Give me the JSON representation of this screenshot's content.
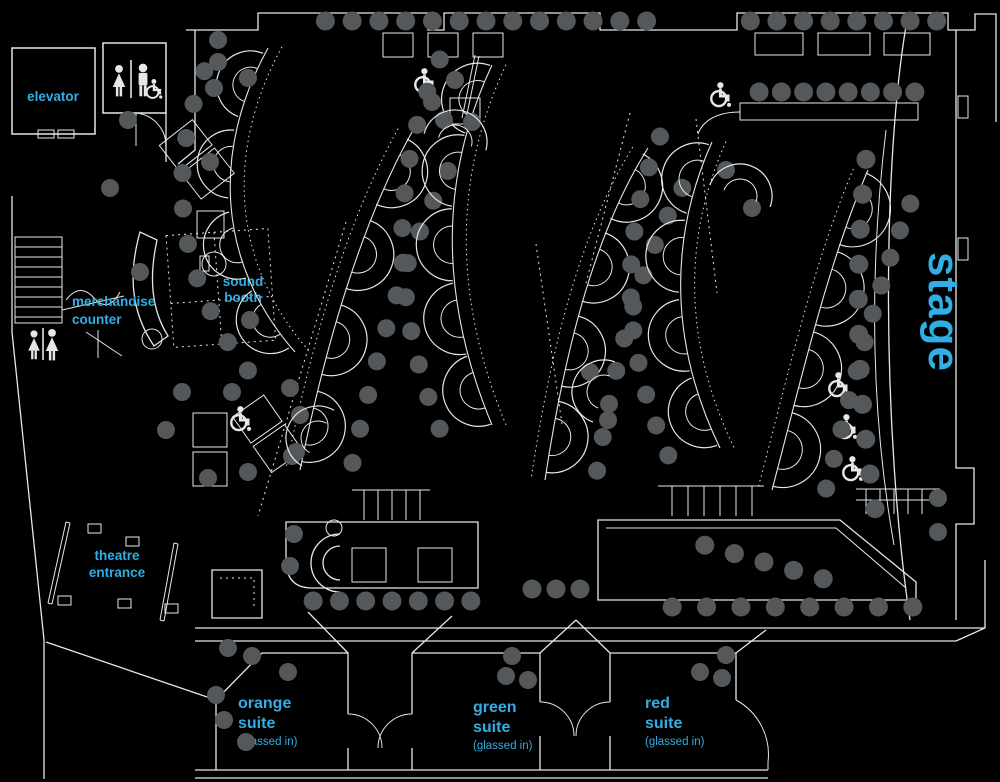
{
  "colors": {
    "background": "#000000",
    "line": "#e6e7e8",
    "seat": "#54585a",
    "accent": "#31aee4"
  },
  "areas": {
    "elevator": {
      "label": "elevator"
    },
    "merchandise_counter": {
      "line1": "merchandise",
      "line2": "counter"
    },
    "sound_booth": {
      "line1": "sound",
      "line2": "booth"
    },
    "theatre_entrance": {
      "line1": "theatre",
      "line2": "entrance"
    },
    "stage": {
      "label": "stage"
    },
    "suites": [
      {
        "id": "orange-suite",
        "line1": "orange",
        "line2": "suite",
        "note": "(glassed in)"
      },
      {
        "id": "green-suite",
        "line1": "green",
        "line2": "suite",
        "note": "(glassed in)"
      },
      {
        "id": "red-suite",
        "line1": "red",
        "line2": "suite",
        "note": "(glassed in)"
      }
    ]
  },
  "icons": {
    "wheelchair": "wheelchair-icon",
    "restroom_women_men": "restroom-icon",
    "restroom_women": "womens-restroom-icon",
    "stairs": "stairs-icon"
  }
}
